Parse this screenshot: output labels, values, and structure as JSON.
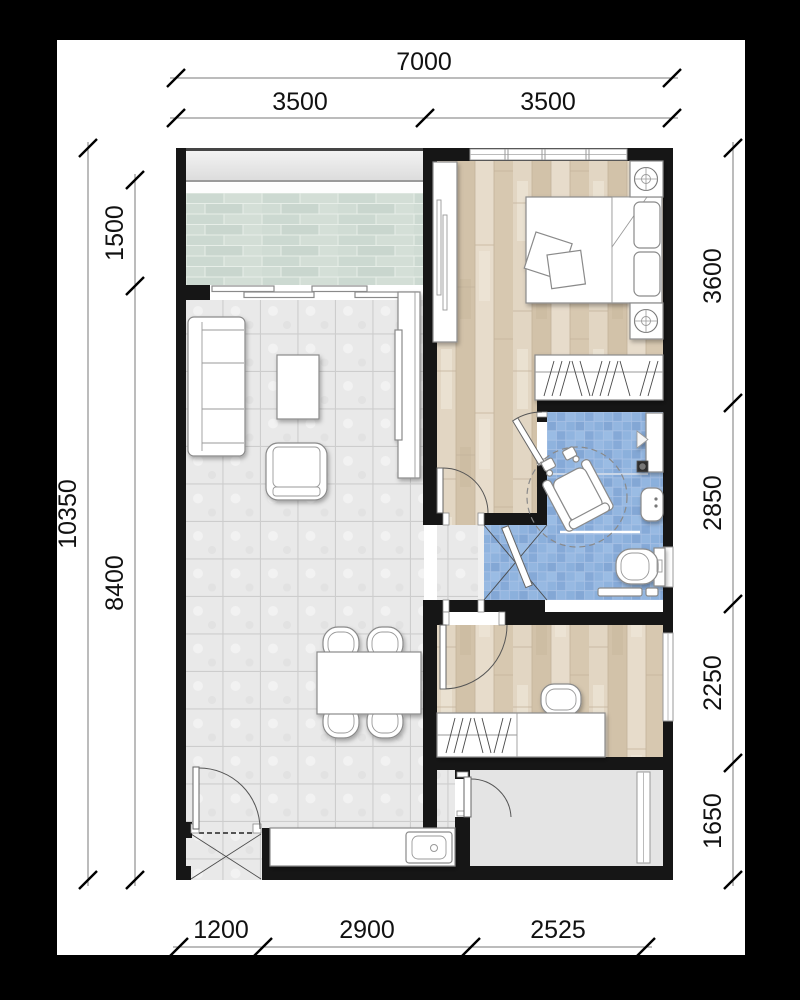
{
  "plan": {
    "title": "apartment-floor-plan",
    "dims": {
      "top_total": "7000",
      "top_a": "3500",
      "top_b": "3500",
      "left_total": "10350",
      "left_a": "1500",
      "left_b": "8400",
      "right_a": "3600",
      "right_b": "2850",
      "right_c": "2250",
      "right_d": "1650",
      "bottom_a": "1200",
      "bottom_b": "2900",
      "bottom_c": "2525"
    },
    "colors": {
      "background": "#000000",
      "paper": "#ffffff",
      "wall": "#161616",
      "living_tile": "#e9e9e9",
      "wood_floor": "#dbcdb6",
      "bathroom_tile": "#8fb3de",
      "balcony_tile": "#ccd9d1",
      "utility_floor": "#e4e4e4"
    }
  }
}
